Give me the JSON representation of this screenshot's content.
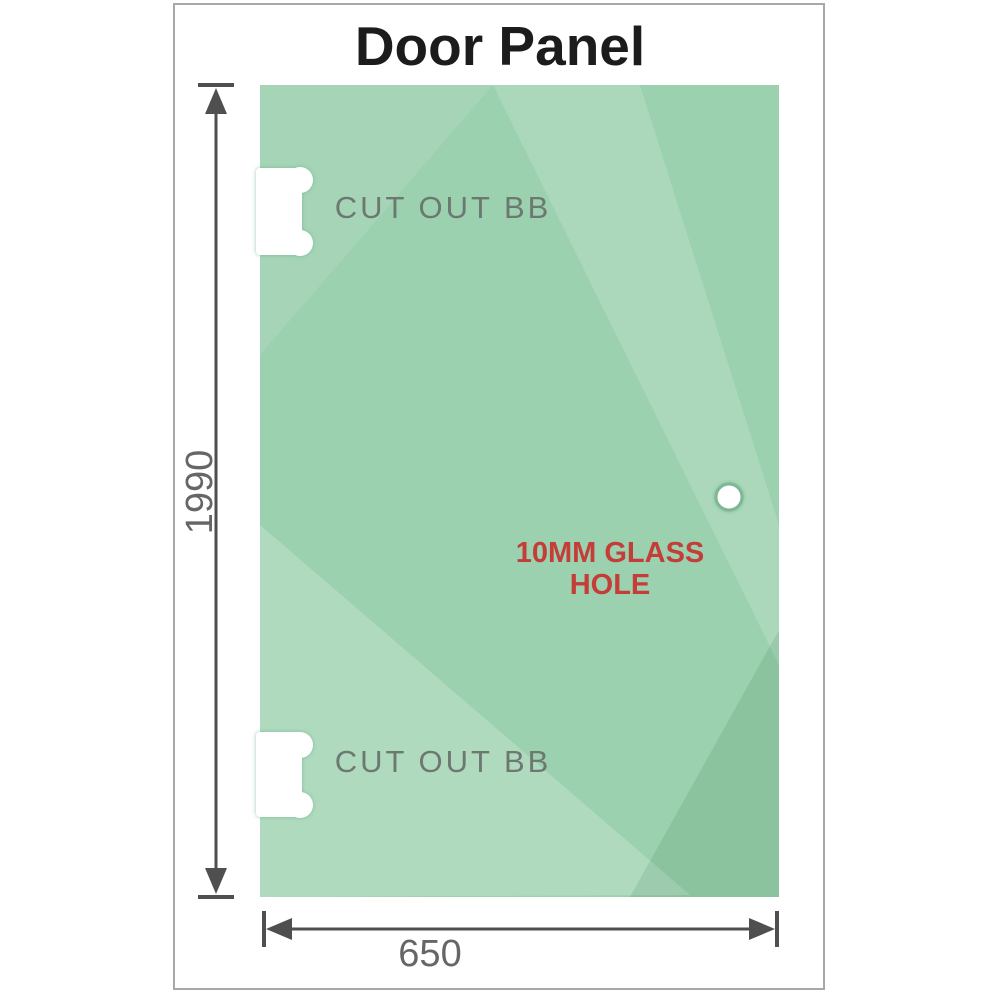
{
  "title": "Door Panel",
  "panel": {
    "top_cutout_label": "CUT OUT BB",
    "bottom_cutout_label": "CUT OUT BB",
    "glass_hole_label": "10MM GLASS HOLE"
  },
  "dimensions": {
    "height": "1990",
    "width": "650"
  },
  "colors": {
    "glass_base": "#9bd1ae",
    "glass_highlight": "#ffffff",
    "glass_shadow_corner": "#1e5f3c",
    "cutout_fill": "#ffffff",
    "cutout_halo": "#5aa87e",
    "dimension_line": "#4f4f4f",
    "dimension_text": "#666666",
    "cutout_text": "#6d7872",
    "hole_text": "#c43d38",
    "title_text": "#1c1c1c",
    "frame_border": "#a6a9a9"
  }
}
